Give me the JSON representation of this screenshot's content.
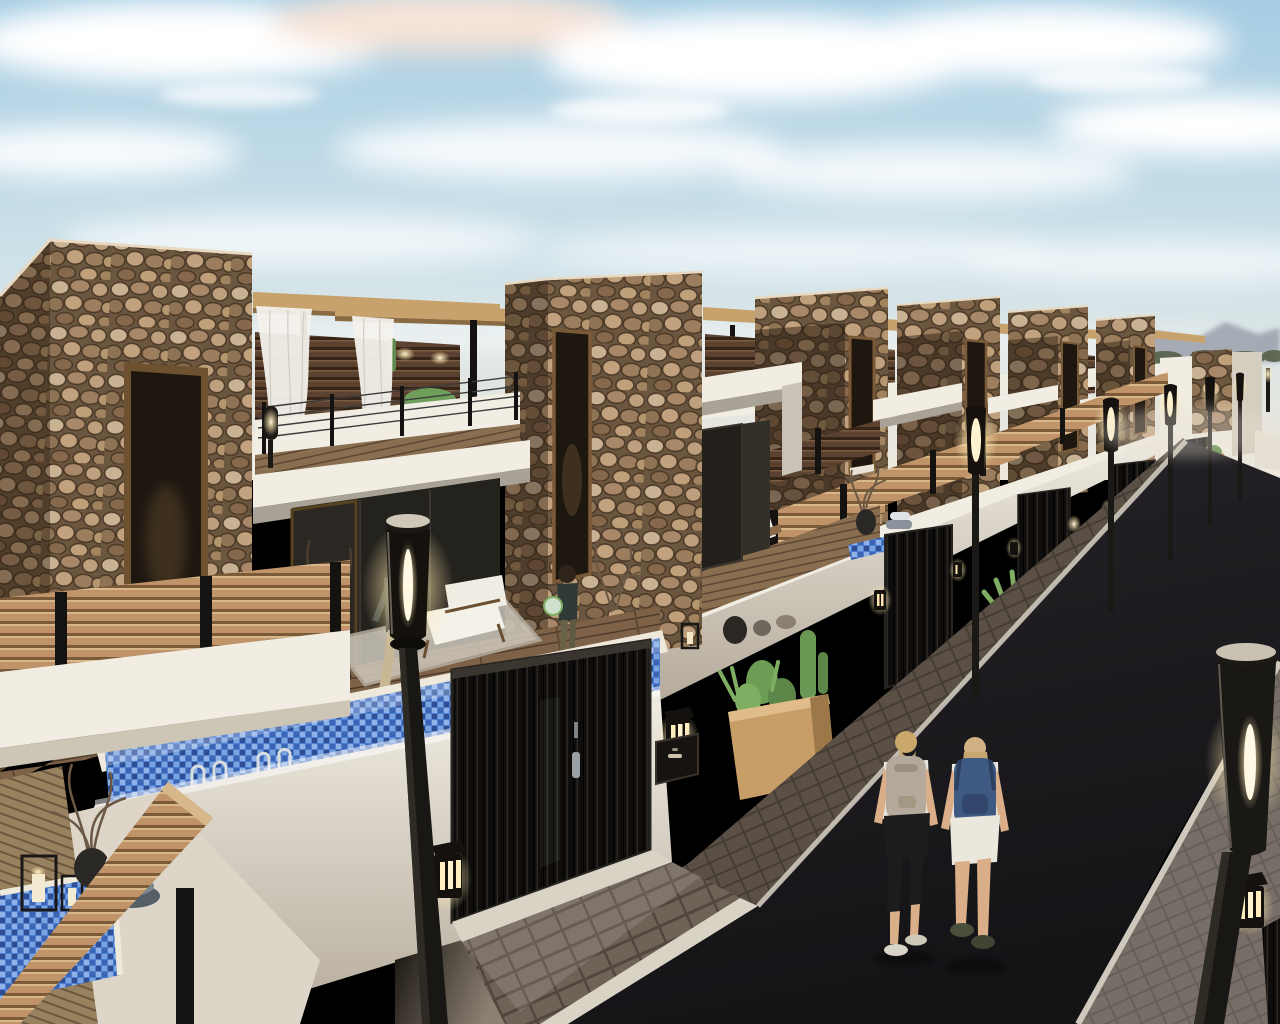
{
  "meta": {
    "type": "3d-architectural-render",
    "description": "Photorealistic rendering of a new-build residential street: a receding row of modern two-storey villas with rubble-stone towers, white stucco walls, wooden slat fences, black entrance gates, rooftop pergolas with white curtains, private plunge pools, modern torch street lamps, planters with cacti, and two pedestrians with backpacks walking on a dark asphalt road under a softly clouded blue sky with distant mountains."
  },
  "palette": {
    "sky_top": "#a6cde4",
    "sky_mid": "#cfe2e9",
    "sky_horizon": "#efe8dc",
    "cloud": "#ffffff",
    "cloud_warm": "#f6e3d7",
    "mountain": "#9aa0ab",
    "stone_base": "#6b5740",
    "stucco": "#f1ede3",
    "wood_slat": "#c09468",
    "privacy_slat": "#5a4130",
    "pergola_wood": "#c8a26d",
    "deck": "#7d6248",
    "pool_water": "#4f7fd0",
    "gate": "#0e0d0c",
    "asphalt": "#262428",
    "asphalt_deep": "#141316",
    "paver": "#5a5046",
    "curb": "#d9d3c6",
    "apron": "#6f6257",
    "glow_core": "#fff8e2",
    "plant": "#6f9e5a",
    "planter_wood": "#c79e68",
    "skin": "#d9ae88",
    "backpack_gray": "#b4a99b",
    "backpack_blue": "#3f5a82",
    "shirt_white": "#e9e6df",
    "pants_black": "#1d1c1c",
    "bronze_frame": "#7a5a36"
  },
  "scene": {
    "setting": "residential street, late afternoon light",
    "counts": {
      "stone_towers": 7,
      "entrance_gates": 4,
      "street_lamps": 7,
      "wall_lanterns": 6,
      "pools": 3,
      "planters": 5,
      "people": 4
    },
    "objects": [
      "row of villas with rubble-stone towers",
      "rooftop pergolas with sheer white curtains",
      "wooden slat privacy fences with black posts",
      "black vertical-slat entrance gates",
      "blue mosaic lap pool with chrome ladders",
      "corner plunge pool with candle lanterns",
      "terrace deck with armchair and rug",
      "man walking on terrace",
      "child holding a ball",
      "two pedestrians with backpacks on the road",
      "modern torch street lamps",
      "glowing wall lanterns",
      "wooden planters with agave and cacti",
      "paved sidewalk with white curbs",
      "dark asphalt street",
      "distant mountains and trees"
    ]
  }
}
